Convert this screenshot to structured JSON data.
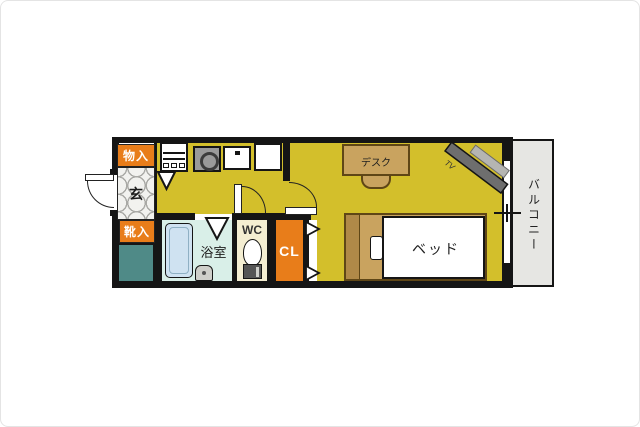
{
  "plan_title": "one-room apartment floor plan",
  "labels": {
    "storage_top": "物入",
    "entrance": "玄",
    "shoe_storage": "靴入",
    "bathroom": "浴室",
    "toilet": "WC",
    "closet": "CL",
    "balcony": "バルコニー",
    "desk": "デスク",
    "bed": "ベッド",
    "tv": "TV"
  },
  "colors": {
    "floor_yellow": "#d3bf2b",
    "label_orange": "#e87d1a",
    "teal_unit": "#4f8a87",
    "bath_floor": "#d9efe8",
    "bathtub": "#cfe2f1",
    "wc_floor": "#f4eed2",
    "wood": "#c9a35f",
    "wood_dark": "#b08948",
    "balcony_gray": "#e6e6e3",
    "wall_black": "#151515",
    "tv_dark": "#6e6e6e",
    "tv_light": "#b5b5b2"
  }
}
